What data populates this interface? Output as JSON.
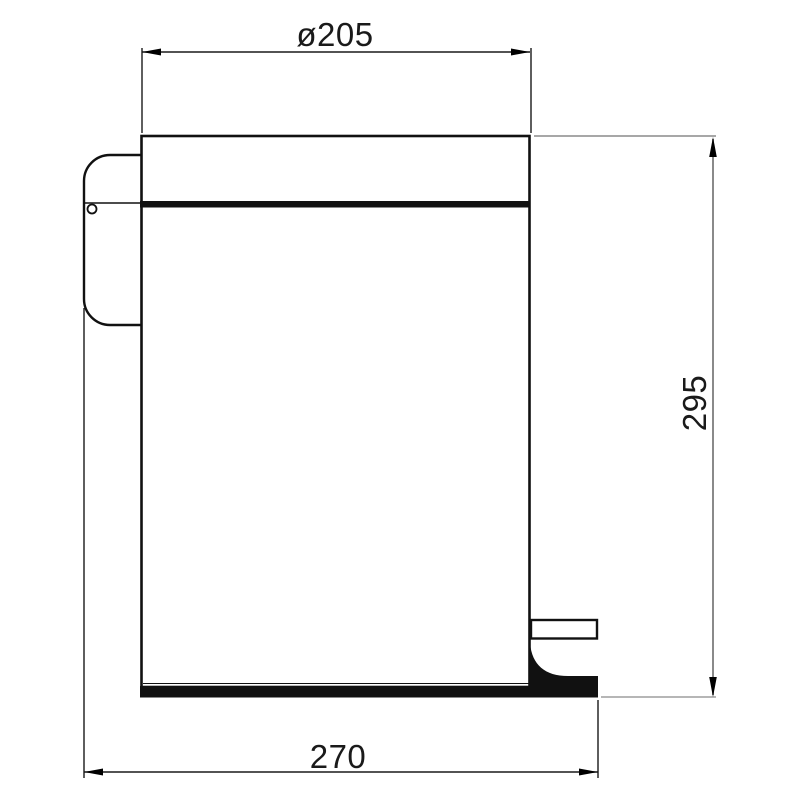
{
  "drawing": {
    "object": "pedal-bin-side-elevation",
    "colors": {
      "outline": "#111111",
      "dimension_lines": "#1a1a1a",
      "height_dimension_line": "#8a8a8a",
      "background": "#ffffff"
    },
    "dimensions": {
      "top_width": "ø205",
      "bottom_width": "270",
      "height": "295"
    }
  }
}
